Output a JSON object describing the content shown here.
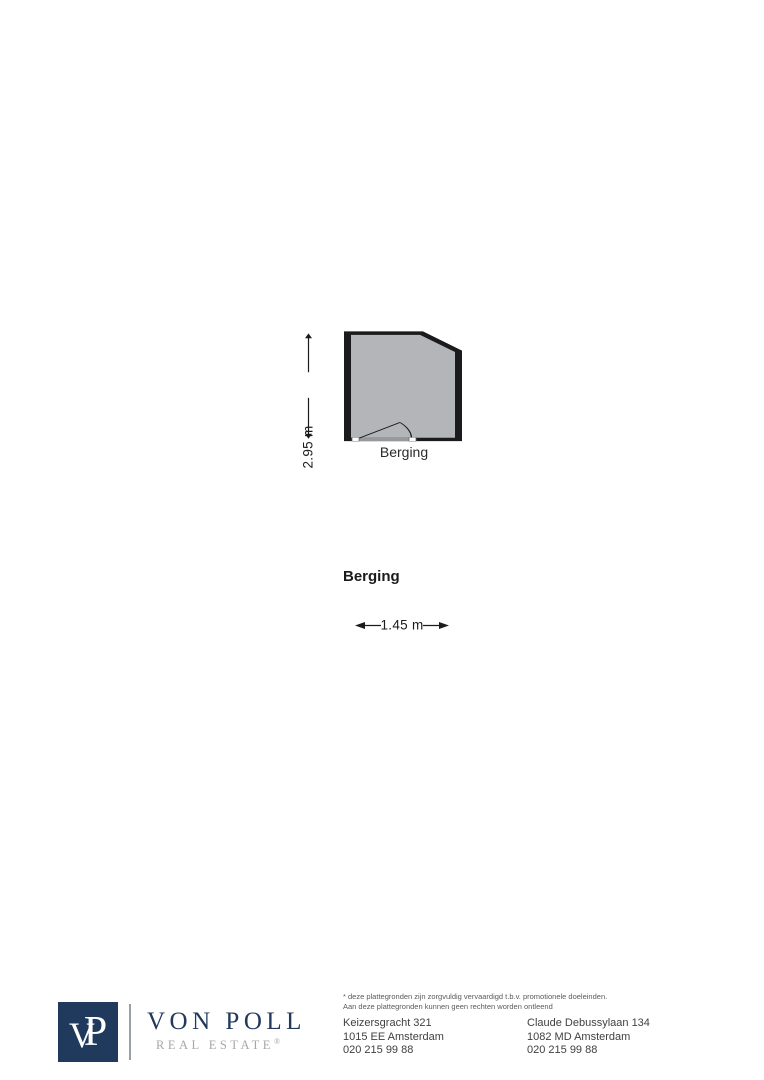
{
  "floorplan": {
    "room_label": "Berging",
    "plan_title": "Berging",
    "vertical_dimension": "2.95 m",
    "horizontal_dimension": "1.45 m",
    "colors": {
      "room_fill": "#b3b5b8",
      "wall": "#1b1b1d",
      "threshold": "#97999c",
      "dimension": "#1b1b1d"
    }
  },
  "footer": {
    "logo": {
      "monogram_v": "V",
      "monogram_p": "P",
      "brand": "VON POLL",
      "subbrand": "REAL ESTATE",
      "registered": "®",
      "navy": "#1f3a5c",
      "subbrand_gray": "#a7a7a9"
    },
    "disclaimer_line1": "* deze plattegronden zijn zorgvuldig vervaardigd t.b.v. promotionele doeleinden.",
    "disclaimer_line2": "Aan deze plattegronden kunnen geen rechten worden ontleend",
    "offices": [
      {
        "address_line1": "Keizersgracht 321",
        "address_line2": "1015 EE Amsterdam",
        "phone": "020 215 99 88"
      },
      {
        "address_line1": "Claude Debussylaan 134",
        "address_line2": "1082 MD Amsterdam",
        "phone": "020 215 99 88"
      }
    ]
  }
}
